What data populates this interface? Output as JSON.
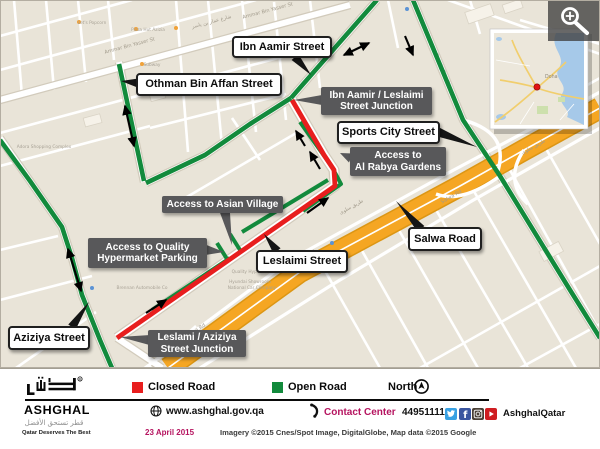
{
  "map": {
    "callouts": [
      {
        "id": "ibn-aamir-street",
        "style": "light",
        "lines": [
          "Ibn Aamir Street"
        ],
        "box": [
          232,
          36,
          100,
          22
        ],
        "base": [
          295,
          57
        ],
        "tip": [
          311,
          75
        ]
      },
      {
        "id": "othman-bin-affan-street",
        "style": "light",
        "lines": [
          "Othman Bin Affan Street"
        ],
        "box": [
          136,
          73,
          146,
          23
        ],
        "base": [
          138,
          83
        ],
        "tip": [
          121,
          81
        ]
      },
      {
        "id": "sports-city-street",
        "style": "light",
        "lines": [
          "Sports City Street"
        ],
        "box": [
          337,
          121,
          103,
          23
        ],
        "base": [
          438,
          132
        ],
        "tip": [
          477,
          147
        ]
      },
      {
        "id": "salwa-road",
        "style": "light",
        "lines": [
          "Salwa Road"
        ],
        "box": [
          408,
          227,
          74,
          24
        ],
        "base": [
          421,
          229
        ],
        "tip": [
          396,
          201
        ]
      },
      {
        "id": "leslaimi-street",
        "style": "light",
        "lines": [
          "Leslaimi Street"
        ],
        "box": [
          256,
          250,
          92,
          23
        ],
        "base": [
          277,
          251
        ],
        "tip": [
          264,
          234
        ]
      },
      {
        "id": "aziziya-street",
        "style": "light",
        "lines": [
          "Aziziya Street"
        ],
        "box": [
          8,
          326,
          82,
          24
        ],
        "base": [
          72,
          327
        ],
        "tip": [
          89,
          302
        ]
      },
      {
        "id": "ibn-aamir-leslaimi-junction",
        "style": "dark",
        "lines": [
          "Ibn Aamir / Leslaimi",
          "Street Junction"
        ],
        "box": [
          321,
          87,
          111,
          28
        ],
        "base": [
          322,
          100
        ],
        "tip": [
          294,
          100
        ]
      },
      {
        "id": "access-al-rabya-gardens",
        "style": "dark",
        "lines": [
          "Access to",
          "Al Rabya Gardens"
        ],
        "box": [
          350,
          147,
          96,
          29
        ],
        "base": [
          351,
          158
        ],
        "tip": [
          340,
          153
        ]
      },
      {
        "id": "access-asian-village",
        "style": "dark",
        "lines": [
          "Access to Asian Village"
        ],
        "box": [
          162,
          196,
          121,
          17
        ],
        "base": [
          225,
          212
        ],
        "tip": [
          232,
          245
        ]
      },
      {
        "id": "access-quality-hypermarket",
        "style": "dark",
        "lines": [
          "Access to Quality",
          "Hypermarket Parking"
        ],
        "box": [
          88,
          238,
          119,
          30
        ],
        "base": [
          206,
          250
        ],
        "tip": [
          224,
          252
        ]
      },
      {
        "id": "leslami-aziziya-junction",
        "style": "dark",
        "lines": [
          "Leslami / Aziziya",
          "Street Junction"
        ],
        "box": [
          148,
          330,
          98,
          27
        ],
        "base": [
          150,
          340
        ],
        "tip": [
          120,
          337
        ]
      }
    ],
    "street_labels": [
      {
        "text": "Ammar Bin Yasser St",
        "x": 130,
        "y": 47,
        "rot": -15
      },
      {
        "text": "شارع عمار بن ياسر",
        "x": 212,
        "y": 23,
        "rot": -15
      },
      {
        "text": "Ammar Bin Yasser St",
        "x": 268,
        "y": 12,
        "rot": -15
      },
      {
        "text": "Sports City St",
        "x": 441,
        "y": 70,
        "rot": 68
      },
      {
        "text": "طريق سلوى",
        "x": 352,
        "y": 208,
        "rot": -29
      },
      {
        "text": "Salwa Rd",
        "x": 306,
        "y": 258,
        "rot": -29
      },
      {
        "text": "Salwa Rd",
        "x": 452,
        "y": 198,
        "rot": -29
      },
      {
        "text": "طريق سلوى",
        "x": 534,
        "y": 148,
        "rot": -29
      },
      {
        "text": "Salwa Rd",
        "x": 196,
        "y": 332,
        "rot": -33
      }
    ],
    "poi_labels": [
      {
        "text": "Let's Popcorn",
        "x": 92,
        "y": 24
      },
      {
        "text": "Pizza Hut Azizia",
        "x": 148,
        "y": 31
      },
      {
        "text": "Subway",
        "x": 152,
        "y": 66
      },
      {
        "text": "Adora Shopping Complex",
        "x": 44,
        "y": 148
      },
      {
        "text": "Quality Hypermarket",
        "x": 254,
        "y": 273
      },
      {
        "text": "Hyundai Showroom",
        "x": 250,
        "y": 283
      },
      {
        "text": "National Car Company",
        "x": 252,
        "y": 289
      },
      {
        "text": "Brennan Automobile Co",
        "x": 142,
        "y": 289
      }
    ],
    "inset": {
      "city_label": "Doha"
    }
  },
  "legend": {
    "closed_label": "Closed Road",
    "open_label": "Open Road",
    "north_label": "North",
    "closed_color": "#e81e1e",
    "open_color": "#128a3c"
  },
  "footer": {
    "brand": {
      "latin": "ASHGHAL",
      "arabic": "قطر تستحق الأفضل",
      "tagline": "Qatar Deserves The Best"
    },
    "website": "www.ashghal.gov.qa",
    "contact_label": "Contact Center",
    "contact_number": "44951111",
    "social_handle": "AshghalQatar",
    "date": "23 April 2015",
    "credits": "Imagery ©2015 Cnes/Spot Image, DigitalGlobe, Map data ©2015 Google",
    "accent_color": "#b5135f"
  }
}
